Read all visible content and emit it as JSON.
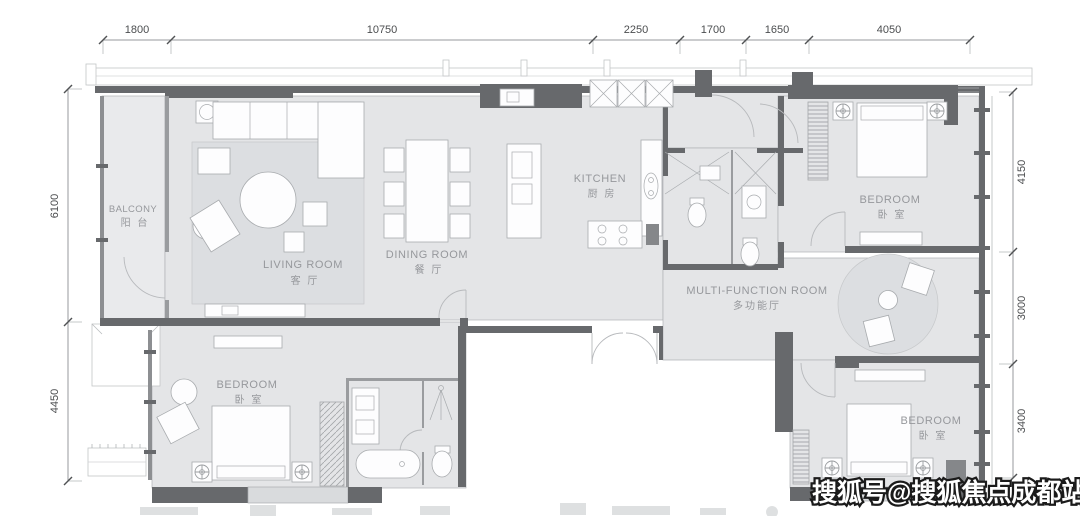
{
  "plan": {
    "title": "apartment-floor-plan",
    "rooms": {
      "balcony": {
        "en": "BALCONY",
        "cn": "阳 台"
      },
      "living": {
        "en": "LIVING ROOM",
        "cn": "客 厅"
      },
      "dining": {
        "en": "DINING ROOM",
        "cn": "餐 厅"
      },
      "kitchen": {
        "en": "KITCHEN",
        "cn": "厨 房"
      },
      "bedroom_top_right": {
        "en": "BEDROOM",
        "cn": "卧 室"
      },
      "multi_function": {
        "en": "MULTI-FUNCTION ROOM",
        "cn": "多功能厅"
      },
      "bedroom_bottom_left": {
        "en": "BEDROOM",
        "cn": "卧 室"
      },
      "bedroom_bottom_right": {
        "en": "BEDROOM",
        "cn": "卧 室"
      }
    },
    "dimensions": {
      "top": [
        "1800",
        "10750",
        "2250",
        "1700",
        "1650",
        "4050"
      ],
      "left": [
        "6100",
        "4450"
      ],
      "right": [
        "4150",
        "3000",
        "3400"
      ]
    },
    "watermark": "搜狐号@搜狐焦点成都站",
    "colors": {
      "floor": "#e4e5e7",
      "wall": "#67696c",
      "label": "#96989c",
      "dimension_text": "#4b4d4f",
      "watermark_fill": "#ffffff",
      "watermark_stroke": "#1b1b1b"
    }
  }
}
